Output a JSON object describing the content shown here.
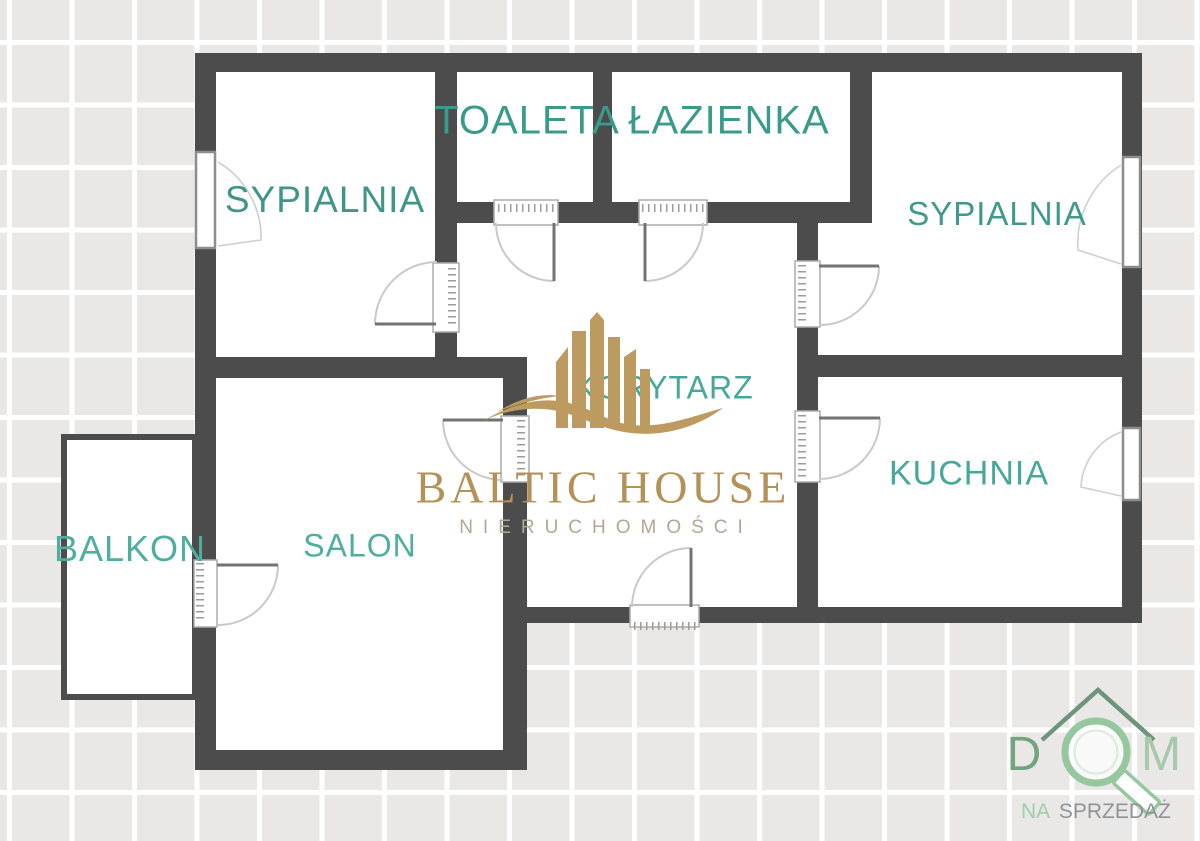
{
  "background": {
    "tile_color": "#e9e8e7",
    "grid_line_color": "#ffffff"
  },
  "plan": {
    "wall_color": "#4c4c4c",
    "room_label_color": "#3f9a8c",
    "rooms": [
      {
        "id": "sypialnia-left",
        "label": "SYPIALNIA"
      },
      {
        "id": "toaleta",
        "label": "TOALETA"
      },
      {
        "id": "lazienka",
        "label": "ŁAZIENKA"
      },
      {
        "id": "sypialnia-right",
        "label": "SYPIALNIA"
      },
      {
        "id": "korytarz",
        "label": "KORYTARZ"
      },
      {
        "id": "kuchnia",
        "label": "KUCHNIA"
      },
      {
        "id": "salon",
        "label": "SALON"
      },
      {
        "id": "balkon",
        "label": "BALKON"
      }
    ]
  },
  "watermark": {
    "brand": "BALTIC HOUSE",
    "subtitle": "NIERUCHOMOŚCI",
    "brand_color": "#b49157",
    "subtitle_color": "#b3a794",
    "icon": "buildings-wave-icon",
    "icon_color": "#bd9a5f"
  },
  "corner_logo": {
    "letter_d": "D",
    "letter_m": "M",
    "tagline_na": "NA",
    "tagline_sprzedaz": "SPRZEDAŻ",
    "house_color": "#6f947b",
    "magnifier_color": "#97c79e",
    "d_color": "#73a47b",
    "m_color": "#a8c8ac",
    "na_color": "#a2cba7",
    "sprzedaz_color": "#8e9398"
  }
}
